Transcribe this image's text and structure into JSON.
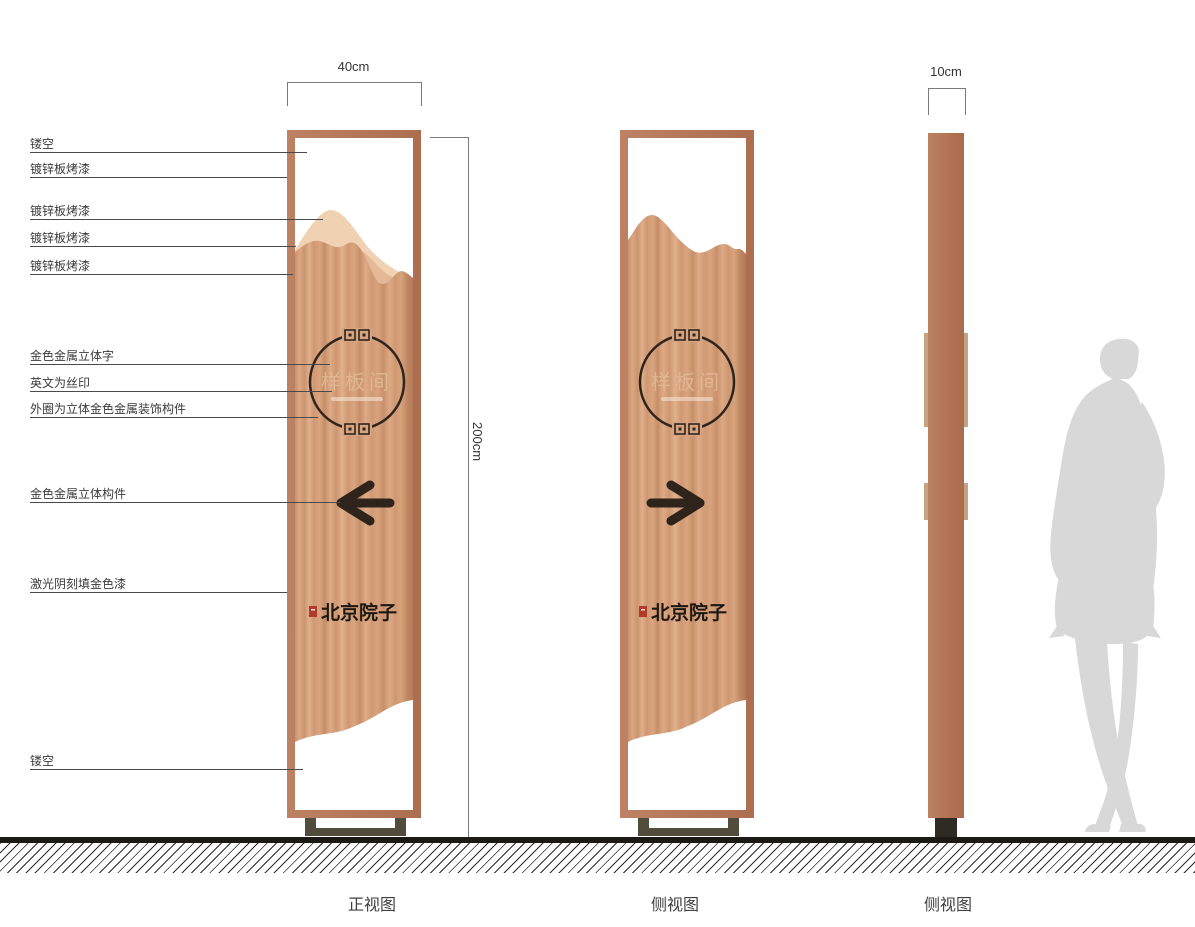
{
  "annotations": {
    "rows": [
      {
        "text": "镂空"
      },
      {
        "text": "镀锌板烤漆"
      },
      {
        "text": "镀锌板烤漆"
      },
      {
        "text": "镀锌板烤漆"
      },
      {
        "text": "镀锌板烤漆"
      },
      {
        "text": "金色金属立体字"
      },
      {
        "text": "英文为丝印"
      },
      {
        "text": "外圈为立体金色金属装饰构件"
      },
      {
        "text": "金色金属立体构件"
      },
      {
        "text": "激光阴刻填金色漆"
      },
      {
        "text": "镂空"
      }
    ]
  },
  "dimensions": {
    "front_width": "40cm",
    "side_width": "10cm",
    "height": "200cm"
  },
  "sign": {
    "room_label": "样板间",
    "brand": "北京院子"
  },
  "captions": {
    "front": "正视图",
    "side1": "侧视图",
    "side2": "侧视图"
  },
  "colors": {
    "frame": "#b87b5c",
    "wood_light": "#dcab86",
    "wood_dark": "#c68e68",
    "mountain_back": "#f0d2b2",
    "mountain_mid": "#e5b997",
    "ink": "#2e241c",
    "seal_red": "#b03a2c",
    "base_olive": "#514c3c",
    "silhouette_gray": "#d8d8d8"
  }
}
